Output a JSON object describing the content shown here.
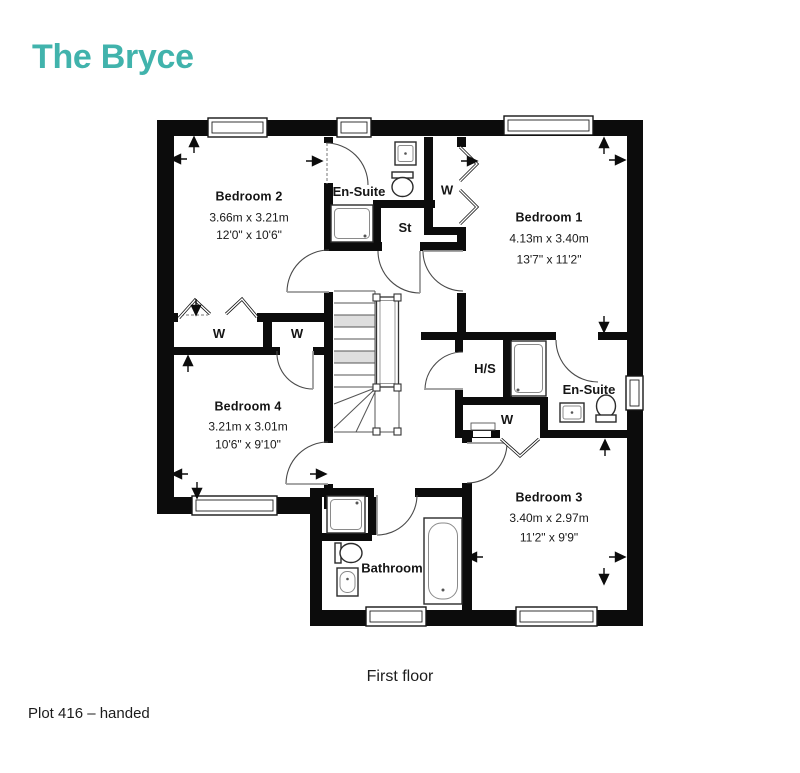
{
  "title": "The Bryce",
  "floor_caption": "First floor",
  "plot_label": "Plot 416 – handed",
  "accent_color": "#41b3ac",
  "plan": {
    "rooms": [
      {
        "name": "Bedroom 2",
        "metric": "3.66m x 3.21m",
        "imperial": "12'0\" x 10'6\""
      },
      {
        "name": "Bedroom 1",
        "metric": "4.13m x 3.40m",
        "imperial": "13'7\" x 11'2\""
      },
      {
        "name": "Bedroom 4",
        "metric": "3.21m x 3.01m",
        "imperial": "10'6\" x 9'10\""
      },
      {
        "name": "Bedroom 3",
        "metric": "3.40m x 2.97m",
        "imperial": "11'2\" x 9'9\""
      }
    ],
    "labels": {
      "ensuite1": "En-Suite",
      "ensuite2": "En-Suite",
      "storage": "St",
      "hot_water_store": "H/S",
      "bathroom": "Bathroom",
      "wardrobe": "W"
    }
  }
}
